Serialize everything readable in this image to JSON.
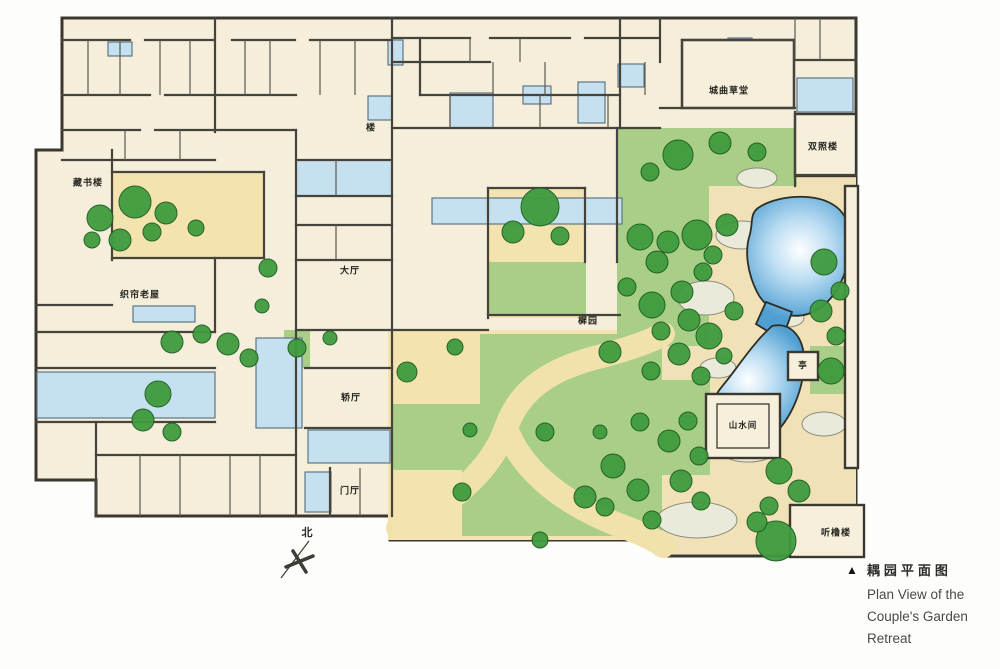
{
  "caption": {
    "marker": "▲",
    "title_zh": "耦园平面图",
    "en_line1": "Plan View of the",
    "en_line2": "Couple's Garden",
    "en_line3": "Retreat"
  },
  "compass": {
    "north_label": "北"
  },
  "plan": {
    "labels": [
      {
        "id": "cangshulou",
        "text": "藏书楼"
      },
      {
        "id": "chengqu-caotang",
        "text": "城曲草堂"
      },
      {
        "id": "shuangzhaolou",
        "text": "双照楼"
      },
      {
        "id": "lou",
        "text": "楼"
      },
      {
        "id": "zhilian-laowu",
        "text": "织帘老屋"
      },
      {
        "id": "dating",
        "text": "大厅"
      },
      {
        "id": "xiyuan",
        "text": "樨园"
      },
      {
        "id": "jiaoting",
        "text": "轿厅"
      },
      {
        "id": "shanshuijian",
        "text": "山水间"
      },
      {
        "id": "ting",
        "text": "亭"
      },
      {
        "id": "menting",
        "text": "门厅"
      },
      {
        "id": "tingchulou",
        "text": "听橹楼"
      }
    ]
  },
  "colors": {
    "paper_cream": "#f5eedb",
    "ground_tan": "#f1e2ac",
    "lawn_green": "#a9ce87",
    "tree_green": "#3f9b3e",
    "courtyard_blue": "#c5e0ee",
    "pond_blue": "#4f9fd2",
    "wall_ink": "#45433c"
  }
}
